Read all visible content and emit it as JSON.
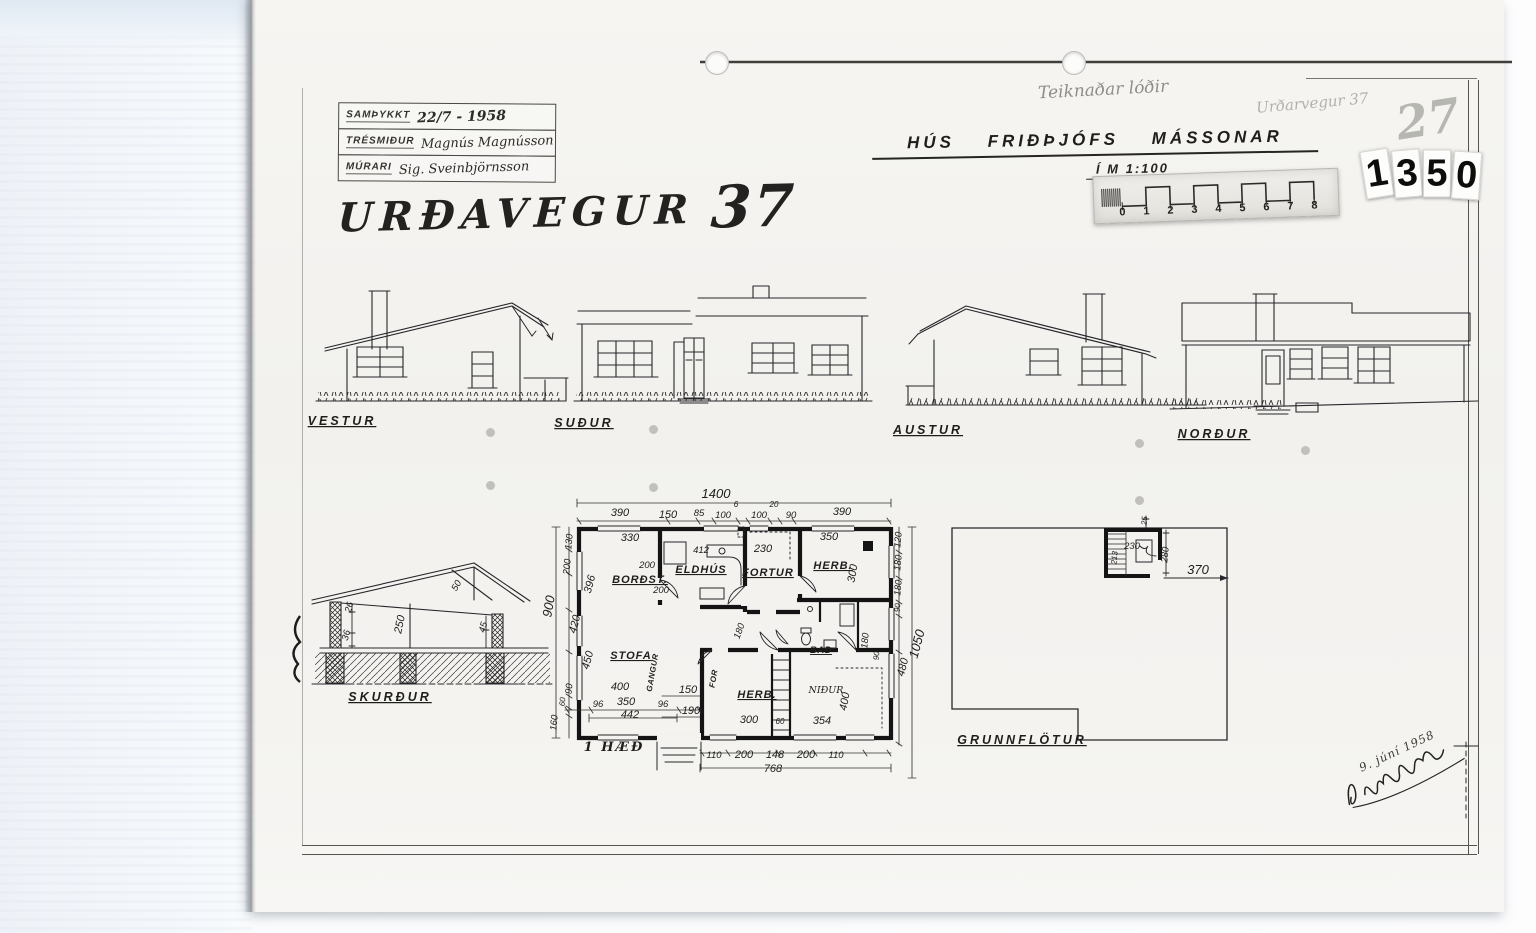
{
  "title_block": {
    "rows": [
      {
        "label": "SAMÞYKKT",
        "value": "22/7 - 1958"
      },
      {
        "label": "TRÉSMIÐUR",
        "value": "Magnús Magnússon"
      },
      {
        "label": "MÚRARI",
        "value": "Sig. Sveinbjörnsson"
      }
    ]
  },
  "street_title": {
    "text": "URÐAVEGUR",
    "number": "37"
  },
  "pencil_notes": {
    "top": "Teiknaðar lóðir",
    "right": "Urðarvegur 37",
    "number": "27"
  },
  "project": {
    "title": "HÚS FRIÐÞJÓFS MÁSSONAR",
    "scale_label": "Í M 1:100"
  },
  "scale_ruler": {
    "numbers": [
      "0",
      "1",
      "2",
      "3",
      "4",
      "5",
      "6",
      "7",
      "8"
    ]
  },
  "archive_number": {
    "value": "1350",
    "digits": [
      "1",
      "3",
      "5",
      "0"
    ]
  },
  "signature": {
    "date": "9. júní 1958"
  },
  "annotations": [
    {
      "t": "VESTUR",
      "x": 342,
      "y": 425,
      "cls": "cap"
    },
    {
      "t": "SUÐUR",
      "x": 584,
      "y": 427,
      "cls": "cap"
    },
    {
      "t": "AUSTUR",
      "x": 928,
      "y": 434,
      "cls": "cap"
    },
    {
      "t": "NORÐUR",
      "x": 1214,
      "y": 438,
      "cls": "cap"
    },
    {
      "t": "SKURÐUR",
      "x": 390,
      "y": 701,
      "cls": "cap"
    },
    {
      "t": "GRUNNFLÖTUR",
      "x": 1022,
      "y": 744,
      "cls": "cap"
    },
    {
      "t": "1 HÆÐ",
      "x": 614,
      "y": 751,
      "cls": "cap-hand"
    },
    {
      "t": "250",
      "x": 403,
      "y": 625,
      "r": -78,
      "cls": "dim"
    },
    {
      "t": "26",
      "x": 352,
      "y": 608,
      "r": -75,
      "cls": "dim-s"
    },
    {
      "t": "36",
      "x": 349,
      "y": 636,
      "r": -75,
      "cls": "dim-s"
    },
    {
      "t": "45",
      "x": 486,
      "y": 628,
      "r": -75,
      "cls": "dim-s"
    },
    {
      "t": "50",
      "x": 459,
      "y": 587,
      "r": -60,
      "cls": "dim-s"
    },
    {
      "t": "1400",
      "x": 716,
      "y": 498,
      "cls": "dim-l"
    },
    {
      "t": "390",
      "x": 620,
      "y": 516,
      "cls": "dim"
    },
    {
      "t": "150",
      "x": 668,
      "y": 518,
      "cls": "dim"
    },
    {
      "t": "85",
      "x": 699,
      "y": 516,
      "cls": "dim-s"
    },
    {
      "t": "100",
      "x": 723,
      "y": 518,
      "cls": "dim-s"
    },
    {
      "t": "6",
      "x": 736,
      "y": 507,
      "cls": "dim-xs"
    },
    {
      "t": "100",
      "x": 759,
      "y": 518,
      "cls": "dim-s"
    },
    {
      "t": "20",
      "x": 774,
      "y": 507,
      "cls": "dim-xs"
    },
    {
      "t": "90",
      "x": 791,
      "y": 518,
      "cls": "dim-s"
    },
    {
      "t": "390",
      "x": 842,
      "y": 515,
      "cls": "dim"
    },
    {
      "t": "900",
      "x": 553,
      "y": 607,
      "r": -80,
      "cls": "dim-l"
    },
    {
      "t": "130",
      "x": 572,
      "y": 542,
      "r": -85,
      "cls": "dim-s"
    },
    {
      "t": "200",
      "x": 570,
      "y": 567,
      "r": -85,
      "cls": "dim-s"
    },
    {
      "t": "396",
      "x": 593,
      "y": 585,
      "r": -75,
      "cls": "dim"
    },
    {
      "t": "420",
      "x": 578,
      "y": 625,
      "r": -75,
      "cls": "dim"
    },
    {
      "t": "450",
      "x": 591,
      "y": 661,
      "r": -75,
      "cls": "dim"
    },
    {
      "t": "90",
      "x": 572,
      "y": 689,
      "r": -85,
      "cls": "dim-s"
    },
    {
      "t": "60",
      "x": 565,
      "y": 702,
      "r": -85,
      "cls": "dim-xs"
    },
    {
      "t": "160",
      "x": 557,
      "y": 723,
      "r": -85,
      "cls": "dim-s"
    },
    {
      "t": "330",
      "x": 630,
      "y": 541,
      "cls": "dim"
    },
    {
      "t": "412",
      "x": 701,
      "y": 553,
      "cls": "dim-s"
    },
    {
      "t": "230",
      "x": 763,
      "y": 552,
      "cls": "dim"
    },
    {
      "t": "350",
      "x": 829,
      "y": 540,
      "cls": "dim"
    },
    {
      "t": "200",
      "x": 647,
      "y": 568,
      "cls": "dim-s"
    },
    {
      "t": "200",
      "x": 661,
      "y": 593,
      "cls": "dim-s"
    },
    {
      "t": "300",
      "x": 856,
      "y": 574,
      "r": -80,
      "cls": "dim"
    },
    {
      "t": "180",
      "x": 742,
      "y": 632,
      "r": -70,
      "cls": "dim-s"
    },
    {
      "t": "BORÐST.",
      "x": 640,
      "y": 583,
      "cls": "room"
    },
    {
      "t": "ELDHÚS",
      "x": 701,
      "y": 573,
      "cls": "room"
    },
    {
      "t": "FORTUR",
      "x": 768,
      "y": 576,
      "cls": "room"
    },
    {
      "t": "HERB.",
      "x": 833,
      "y": 569,
      "cls": "room"
    },
    {
      "t": "STOFA",
      "x": 631,
      "y": 659,
      "cls": "room"
    },
    {
      "t": "HERB.",
      "x": 757,
      "y": 698,
      "cls": "room"
    },
    {
      "t": "BAÐ",
      "x": 821,
      "y": 653,
      "cls": "room-s"
    },
    {
      "t": "NIÐUR",
      "x": 826,
      "y": 693,
      "cls": "hand-s"
    },
    {
      "t": "GANGUR",
      "x": 655,
      "y": 673,
      "r": -80,
      "cls": "room-xs"
    },
    {
      "t": "FOR",
      "x": 716,
      "y": 679,
      "r": -80,
      "cls": "room-xs"
    },
    {
      "t": "400",
      "x": 620,
      "y": 690,
      "cls": "dim"
    },
    {
      "t": "150",
      "x": 688,
      "y": 693,
      "cls": "dim"
    },
    {
      "t": "190",
      "x": 691,
      "y": 714,
      "cls": "dim"
    },
    {
      "t": "96",
      "x": 598,
      "y": 707,
      "cls": "dim-s"
    },
    {
      "t": "350",
      "x": 626,
      "y": 705,
      "cls": "dim"
    },
    {
      "t": "96",
      "x": 663,
      "y": 707,
      "cls": "dim-s"
    },
    {
      "t": "442",
      "x": 630,
      "y": 718,
      "cls": "dim"
    },
    {
      "t": "300",
      "x": 749,
      "y": 723,
      "cls": "dim"
    },
    {
      "t": "60",
      "x": 780,
      "y": 724,
      "cls": "dim-xs"
    },
    {
      "t": "354",
      "x": 822,
      "y": 724,
      "cls": "dim"
    },
    {
      "t": "400",
      "x": 848,
      "y": 702,
      "r": -80,
      "cls": "dim"
    },
    {
      "t": "180",
      "x": 868,
      "y": 641,
      "r": -85,
      "cls": "dim-s"
    },
    {
      "t": "90",
      "x": 879,
      "y": 656,
      "r": -85,
      "cls": "dim-xs"
    },
    {
      "t": "120",
      "x": 901,
      "y": 540,
      "r": -85,
      "cls": "dim-s"
    },
    {
      "t": "180",
      "x": 901,
      "y": 563,
      "r": -85,
      "cls": "dim-s"
    },
    {
      "t": "180",
      "x": 901,
      "y": 588,
      "r": -85,
      "cls": "dim-s"
    },
    {
      "t": "90",
      "x": 900,
      "y": 608,
      "r": -85,
      "cls": "dim-xs"
    },
    {
      "t": "480",
      "x": 906,
      "y": 668,
      "r": -75,
      "cls": "dim"
    },
    {
      "t": "1050",
      "x": 921,
      "y": 645,
      "r": -75,
      "cls": "dim-l"
    },
    {
      "t": "110",
      "x": 714,
      "y": 758,
      "cls": "dim-s"
    },
    {
      "t": "200",
      "x": 744,
      "y": 758,
      "cls": "dim"
    },
    {
      "t": "148",
      "x": 775,
      "y": 758,
      "cls": "dim"
    },
    {
      "t": "200",
      "x": 806,
      "y": 758,
      "cls": "dim"
    },
    {
      "t": "110",
      "x": 836,
      "y": 758,
      "cls": "dim-s"
    },
    {
      "t": "768",
      "x": 773,
      "y": 772,
      "cls": "dim"
    },
    {
      "t": "25",
      "x": 1147,
      "y": 521,
      "r": -85,
      "cls": "dim-xs"
    },
    {
      "t": "230",
      "x": 1132,
      "y": 549,
      "cls": "dim-s"
    },
    {
      "t": "213",
      "x": 1117,
      "y": 558,
      "r": -85,
      "cls": "dim-xs"
    },
    {
      "t": "280",
      "x": 1168,
      "y": 555,
      "r": -85,
      "cls": "dim-s"
    },
    {
      "t": "370",
      "x": 1198,
      "y": 574,
      "cls": "dim-l"
    }
  ]
}
